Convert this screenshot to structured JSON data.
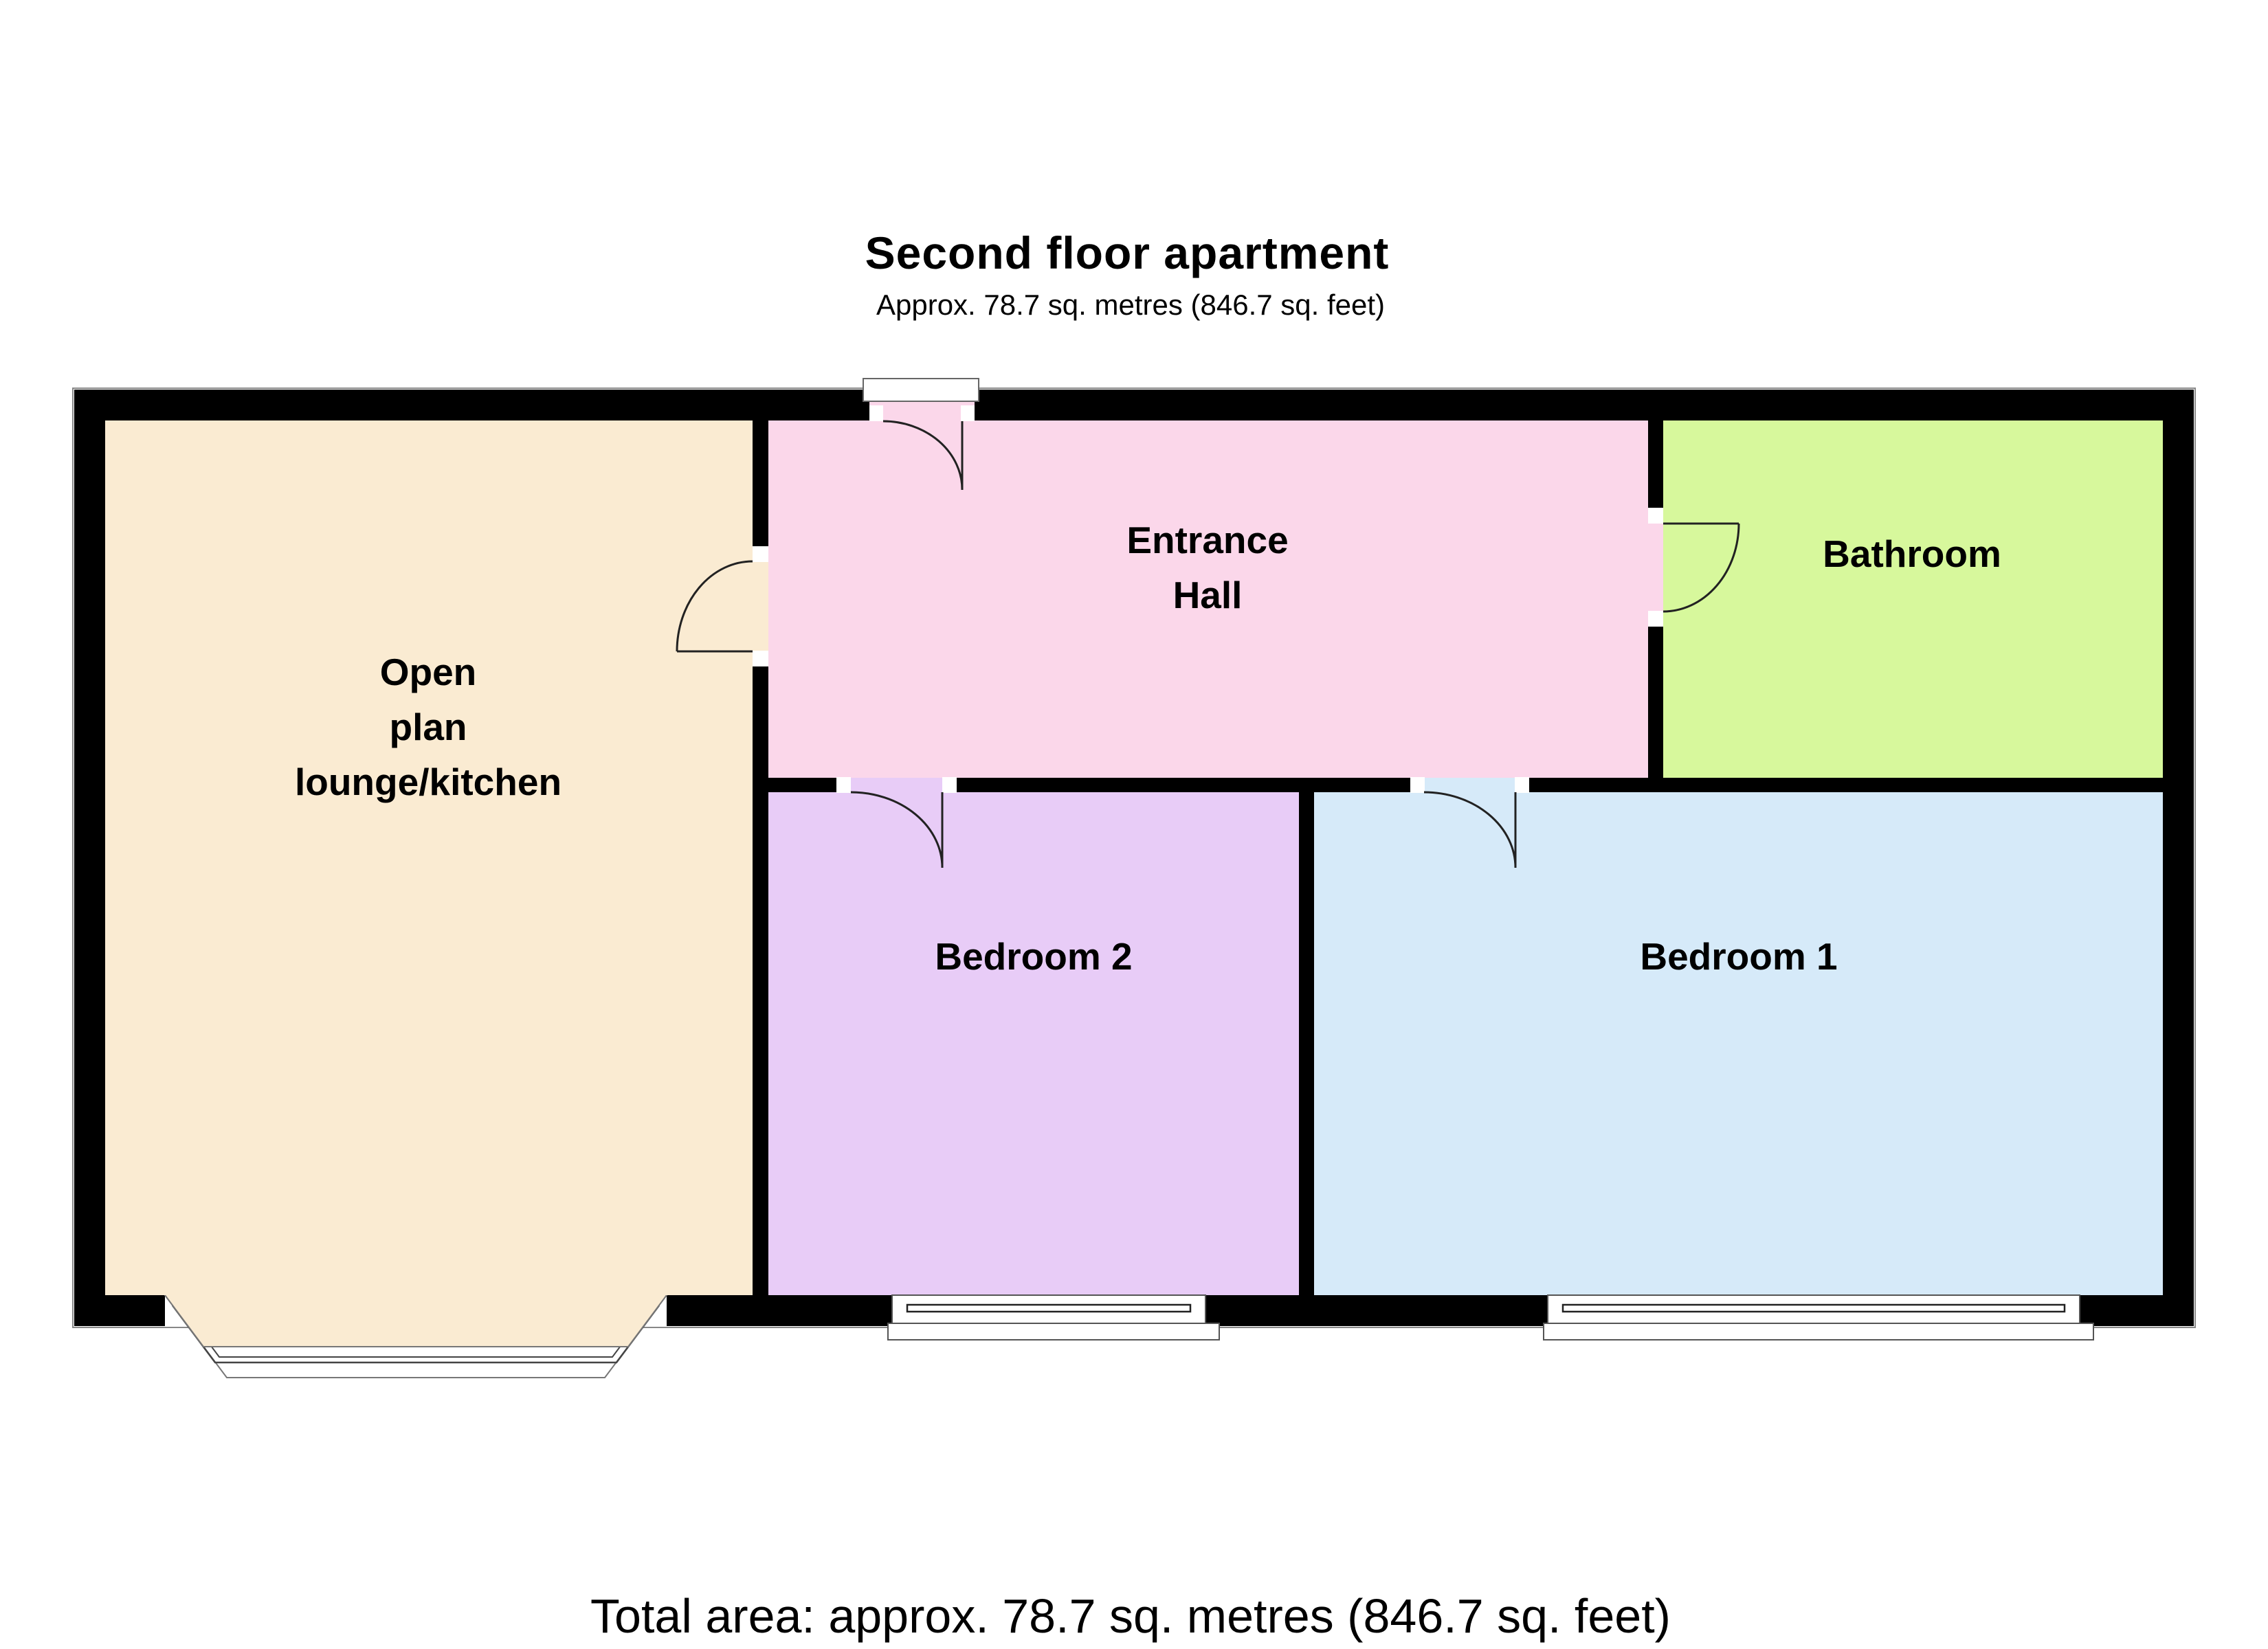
{
  "header": {
    "title": "Second floor apartment",
    "subtitle": "Approx. 78.7 sq. metres (846.7 sq. feet)"
  },
  "rooms": {
    "open_plan": {
      "name": "Open plan lounge/kitchen",
      "label": "Open\nplan\nlounge/kitchen",
      "color": "#FAEBD2"
    },
    "entrance_hall": {
      "name": "Entrance Hall",
      "label": "Entrance\nHall",
      "color": "#FBD7EA"
    },
    "bathroom": {
      "name": "Bathroom",
      "label": "Bathroom",
      "color": "#D7F89C"
    },
    "bedroom_2": {
      "name": "Bedroom 2",
      "label": "Bedroom 2",
      "color": "#E8CCF7"
    },
    "bedroom_1": {
      "name": "Bedroom 1",
      "label": "Bedroom 1",
      "color": "#D6EAF9"
    }
  },
  "footer": {
    "total_area": "Total area: approx. 78.7 sq. metres (846.7 sq. feet)"
  },
  "palette": {
    "wall": "#000000",
    "outline": "#888888",
    "door_stroke": "#222222"
  }
}
